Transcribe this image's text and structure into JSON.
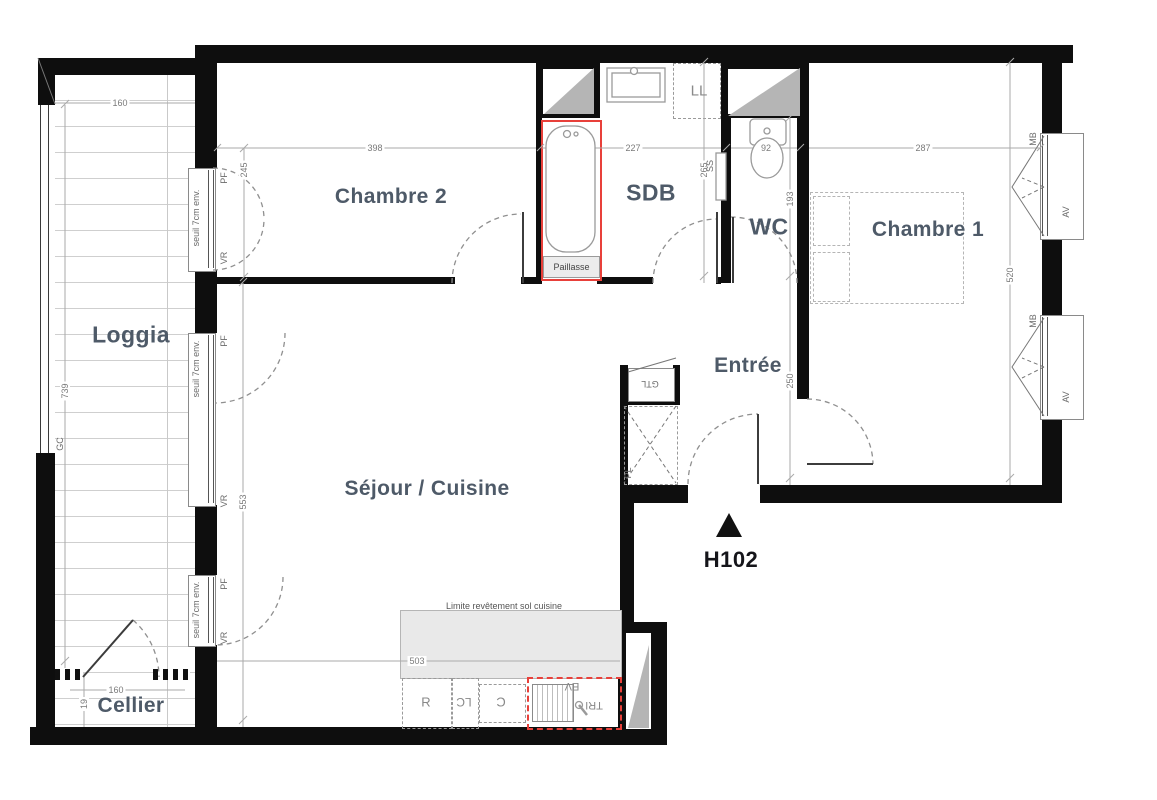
{
  "plan": {
    "unit": {
      "id": "H102"
    },
    "rooms": {
      "chambre2": "Chambre 2",
      "sdb": "SDB",
      "wc": "WC",
      "chambre1": "Chambre 1",
      "loggia": "Loggia",
      "sejour": "Séjour / Cuisine",
      "entree": "Entrée",
      "cellier": "Cellier"
    },
    "dims": {
      "loggia_top": "160",
      "chambre2_w": "398",
      "sdb_w": "227",
      "wc_w": "92",
      "chambre1_w": "287",
      "window_c2": "245",
      "sdb_h": "265",
      "wc_h": "193",
      "chambre1_h": "520",
      "entree_h": "250",
      "loggia_h": "739",
      "sejour_h": "553",
      "cuisine_w": "503",
      "cellier_w": "160",
      "cellier_s": "19"
    },
    "ann": {
      "seuil": "seuil 7cm env.",
      "pf": "PF",
      "vr": "VR",
      "av": "AV",
      "mb": "MB",
      "gc": "GC",
      "ll": "LL",
      "ss": "SS",
      "gtl": "GTL",
      "pl": "PL",
      "paillasse": "Paillasse",
      "limite": "Limite revêtement sol cuisine",
      "kitchen_r": "R",
      "kitchen_lc": "LC",
      "kitchen_c": "C",
      "kitchen_ev": "EV",
      "kitchen_tri": "TRI"
    },
    "colors": {
      "label": "#4e5a68",
      "dimension": "#7a7a7a",
      "accent_red": "#e8403a",
      "wall": "#0e0e0e",
      "kitchen_floor": "#e9e9e9",
      "shaft_gray": "#b5b5b5"
    }
  }
}
